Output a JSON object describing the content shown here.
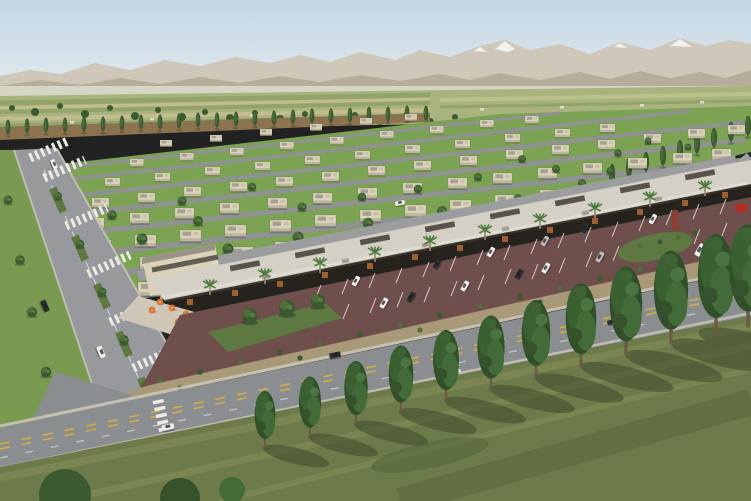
{
  "meta": {
    "type": "architectural-aerial-rendering",
    "description": "Aerial rendering of a desert-suburb master-planned community: rows of flat-roofed beige villas on green lawns, a long retail strip with canopy roof, palm trees and orange cafe umbrellas, a maroon parking lot with angled stalls, a tree-lined boulevard with planted medians, an arterial road with yellow centerlines, and a foreground row of tall columnar trees; tan mountains with snow patches on the horizon."
  },
  "palette": {
    "sky_top": "#c4d6e3",
    "sky_bottom": "#e3ebf0",
    "mountain_far": "#cfc8ba",
    "mountain_near": "#b4aa98",
    "snow": "#f4f5f1",
    "haze": "#e0e4d6",
    "field_base": "#a8b37f",
    "field_stripe_dark": "#93a468",
    "field_stripe_light": "#c3bc8e",
    "dirt_strip": "#8b7350",
    "lawn": "#7ca253",
    "street": "#8f9193",
    "boulevard": "#97999c",
    "main_road": "#8b8e91",
    "service_road": "#9b9d9f",
    "sidewalk": "#c9c4b6",
    "crosswalk": "#eceae6",
    "median_green": "#5d7841",
    "verge_green": "#7a9a52",
    "parking": "#6f4f4b",
    "stall_stripe": "#e8e4de",
    "roof": "#d4d0c6",
    "fascia": "#38342e",
    "storefront": "#26221d",
    "glow": "#b26a33",
    "plaza": "#cfc8b8",
    "house_wall": "#dbd2ba",
    "tree_dark": "#3c5a31",
    "tree_mid": "#4e7038",
    "tree_light": "#64854a",
    "palm": "#4c7a3c",
    "umbrella": "#d9752e",
    "gravel_strip": "#a89a78",
    "grass_fg": "#6d7a49",
    "grass_light": "#8a945c",
    "grass_dark": "#45552f",
    "tree_shadow": "#3a482b",
    "center_yellow": "#d9b23e",
    "car_white": "#f1f1f1",
    "car_dark": "#2b2e31",
    "car_silver": "#bcbfc1",
    "sign_red": "#b03028",
    "sculpture": "#8a4030",
    "trunk": "#6b5a44"
  },
  "scene": {
    "houses_visible": 75,
    "residential_rows": 8,
    "foreground_columnar_trees": 12,
    "top_poplar_row_trees": 23,
    "right_poplar_row_trees": 9,
    "retail_palm_trees": 10,
    "cafe_umbrellas": 7,
    "parked_cars": 18,
    "moving_cars": 10,
    "parking_stall_rows": 2,
    "boulevard_median_islands": 5,
    "crosswalks": 8
  }
}
